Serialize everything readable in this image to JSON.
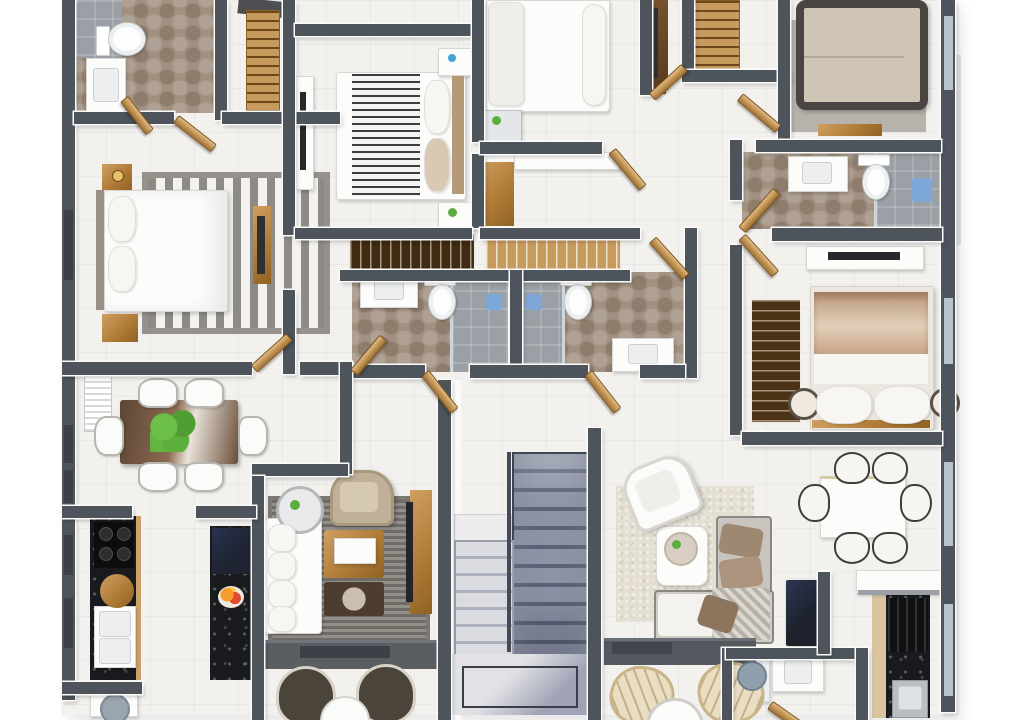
{
  "scene": {
    "type": "floor-plan-3d-render",
    "view": "top-down",
    "text_labels": "none visible"
  },
  "palette": {
    "background": "#ffffff",
    "floor": "#f2f1ee",
    "wall_dark": "#4e545c",
    "wall_face": "#f8f8f7",
    "wood_light": "#c79a5e",
    "wood_dark": "#4b3115",
    "bath_hex_tile": "#a29181",
    "shower_tile": "#9aa0a5",
    "black_marble": "#191a1d",
    "rug_gray": "#8e8b85",
    "rug_beige": "#e5dfd3",
    "stair_carpet_dark": "#5e6478",
    "stair_carpet_light": "#aeb1bd",
    "accent_towel_blue": "#7da7d9",
    "plant_green": "#5cae3e",
    "bed_linen_white": "#fcfcfb",
    "blanket_tan": "#c8a488",
    "fridge_dark": "#1d2330"
  },
  "rooms": [
    "bathroom-top-left",
    "closet-top-left",
    "bedroom-left",
    "bedroom-mid-top",
    "bedroom-top-center",
    "corridor-closet-center",
    "closet-top-right",
    "bedroom-top-right",
    "bathroom-right",
    "bedroom-right",
    "bathroom-mid-left",
    "bathroom-mid-right",
    "dining-left",
    "kitchen-left",
    "laundry-left",
    "living-left",
    "staircase",
    "living-right",
    "dining-right",
    "kitchen-right",
    "bathroom-bottom",
    "hallways"
  ],
  "furniture": [
    "double-bed x5",
    "toilet x4",
    "sink-vanity x5",
    "shower x4",
    "dining-table x2",
    "dining-chair x12",
    "sofa x2",
    "armchair x2",
    "coffee-table x2",
    "tv-console x4",
    "wardrobe-rail-closet x4",
    "ladder-shelf x2",
    "kitchen-counter x4",
    "gas-stove x2",
    "kitchen-sink x2",
    "fridge x2",
    "washing-machine x2",
    "staircase-double-flight x1",
    "round-table x2",
    "lounge-chair x4",
    "radiator x1",
    "potted-plant x1"
  ]
}
